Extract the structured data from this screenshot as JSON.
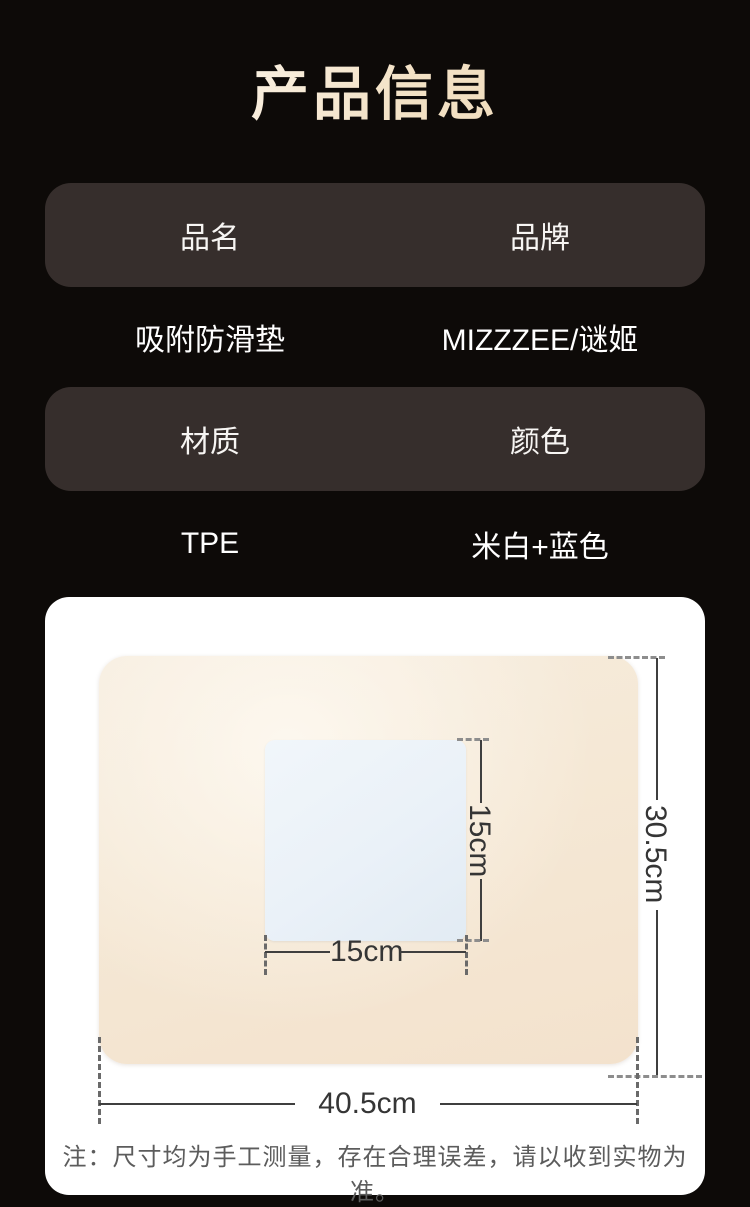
{
  "title": "产品信息",
  "table": {
    "rows": [
      {
        "type": "header",
        "left": "品名",
        "right": "品牌"
      },
      {
        "type": "value",
        "left": "吸附防滑垫",
        "right": "MIZZZEE/谜姬"
      },
      {
        "type": "header",
        "left": "材质",
        "right": "颜色"
      },
      {
        "type": "value",
        "left": "TPE",
        "right": "米白+蓝色"
      }
    ]
  },
  "figure": {
    "inner_height_label": "15cm",
    "inner_width_label": "15cm",
    "mat_width_label": "40.5cm",
    "mat_height_label": "30.5cm",
    "note": "注：尺寸均为手工测量，存在合理误差，请以收到实物为准。"
  },
  "colors": {
    "background": "#0d0a08",
    "header_pill": "#362e2c",
    "title_gradient_start": "#ffffff",
    "title_gradient_end": "#ecd6b2",
    "mat": "#f5e8d5",
    "pad": "#eaf1f8",
    "dimension_line": "#3f3f3f",
    "note_text": "#5c5c5c"
  }
}
